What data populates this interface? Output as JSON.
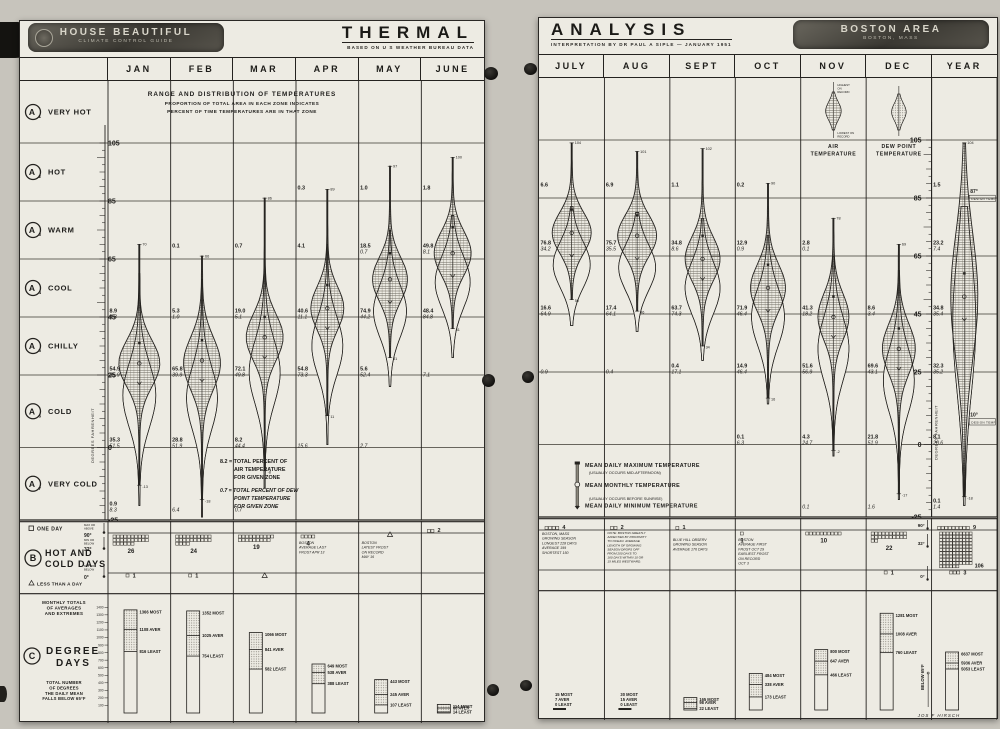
{
  "document": {
    "left_page": {
      "badge": {
        "line1": "HOUSE BEAUTIFUL",
        "line2": "CLIMATE CONTROL GUIDE"
      },
      "title": "THERMAL",
      "subtitle": "BASED ON U S WEATHER BUREAU DATA",
      "months": [
        "JAN",
        "FEB",
        "MAR",
        "APR",
        "MAY",
        "JUNE"
      ]
    },
    "right_page": {
      "title": "ANALYSIS",
      "subtitle": "INTERPRETATION BY DR PAUL A SIPLE  —  JANUARY 1951",
      "badge": {
        "line1": "BOSTON AREA",
        "line2": "BOSTON, MASS"
      },
      "months": [
        "JULY",
        "AUG",
        "SEPT",
        "OCT",
        "NOV",
        "DEC",
        "YEAR"
      ]
    },
    "intro": [
      "RANGE AND DISTRIBUTION OF TEMPERATURES",
      "PROPORTION OF TOTAL AREA IN EACH ZONE INDICATES",
      "PERCENT OF TIME TEMPERATURES ARE IN THAT ZONE"
    ],
    "zones": [
      {
        "letter": "A",
        "sub": "1",
        "label": "VERY HOT"
      },
      {
        "letter": "A",
        "sub": "2",
        "label": "HOT"
      },
      {
        "letter": "A",
        "sub": "3",
        "label": "WARM"
      },
      {
        "letter": "A",
        "sub": "4",
        "label": "COOL"
      },
      {
        "letter": "A",
        "sub": "5",
        "label": "CHILLY"
      },
      {
        "letter": "A",
        "sub": "6",
        "label": "COLD"
      },
      {
        "letter": "A",
        "sub": "7",
        "label": "VERY COLD"
      }
    ],
    "scale_label": "DEGREES FAHRENHEIT",
    "air_legend": [
      "8.2 = TOTAL PERCENT OF",
      "AIR TEMPERATURE",
      "FOR GIVEN ZONE"
    ],
    "dew_legend": [
      "0.7 = TOTAL PERCENT OF DEW",
      "POINT TEMPERATURE",
      "FOR GIVEN ZONE"
    ],
    "mean_legend": [
      "MEAN DAILY MAXIMUM TEMPERATURE",
      "(USUALLY OCCURS MID-AFTERNOON)",
      "MEAN MONTHLY TEMPERATURE",
      "(USUALLY OCCURS BEFORE SUNRISE)",
      "MEAN DAILY MINIMUM TEMPERATURE"
    ],
    "inset": {
      "highest": [
        "HIGHEST",
        "ON",
        "RECORD"
      ],
      "lowest": [
        "LOWEST ON",
        "RECORD"
      ],
      "air": [
        "AIR",
        "TEMPERATURE"
      ],
      "dew": [
        "DEW POINT",
        "TEMPERATURE"
      ]
    },
    "design_temps": [
      {
        "temp": "87°",
        "label": "DESIGN TEMP",
        "at": 87
      },
      {
        "temp": "10°",
        "label": "DESIGN TEMP",
        "at": 10
      }
    ],
    "signature": "JOS F HIRSCH"
  },
  "chart_data": {
    "type": "violin-distribution",
    "title": "THERMAL ANALYSIS — RANGE AND DISTRIBUTION OF TEMPERATURES, BOSTON AREA",
    "ylabel": "DEGREES FAHRENHEIT",
    "y_ticks": [
      105,
      85,
      65,
      45,
      25,
      0,
      -25
    ],
    "ylim": [
      -25,
      115
    ],
    "zone_bounds": {
      "very_hot": "105+",
      "hot": "85-105",
      "warm": "65-85",
      "cool": "45-65",
      "chilly": "25-45",
      "cold": "0-25",
      "very_cold": "-25-0"
    },
    "pct_format": "[air %, dew point %] of time in zone",
    "months": [
      {
        "name": "JAN",
        "page": "L",
        "col": 0,
        "record_high": 70,
        "record_low": -13,
        "markers": {
          "max": 36,
          "mean": 29,
          "min": 22
        },
        "pct": {
          "cool": [
            "8.9",
            "4.3"
          ],
          "chilly": [
            "54.9",
            "35.9"
          ],
          "cold": [
            "35.3",
            "51.5"
          ],
          "very_cold": [
            "0.9",
            "8.3"
          ]
        },
        "shape": {
          "air": {
            "c": 29,
            "s": 8,
            "w": 20
          },
          "dew": {
            "hi": 60,
            "lo": -20,
            "c": 18,
            "s": 11,
            "w": 16
          }
        }
      },
      {
        "name": "FEB",
        "page": "L",
        "col": 1,
        "record_high": 66,
        "record_low": -18,
        "markers": {
          "max": 37,
          "mean": 30,
          "min": 23
        },
        "pct": {
          "warm": [
            "0.1",
            null
          ],
          "cool": [
            "5.3",
            "1.0"
          ],
          "chilly": [
            "65.8",
            "39.9"
          ],
          "cold": [
            "28.8",
            "51.9"
          ],
          "very_cold": [
            null,
            "6.4"
          ]
        },
        "shape": {
          "air": {
            "c": 29,
            "s": 9,
            "w": 18
          },
          "dew": {
            "hi": 58,
            "lo": -24,
            "c": 17,
            "s": 11,
            "w": 15
          }
        }
      },
      {
        "name": "MAR",
        "page": "L",
        "col": 2,
        "record_high": 86,
        "record_low": -8,
        "markers": {
          "max": 45,
          "mean": 38,
          "min": 31
        },
        "pct": {
          "warm": [
            "0.7",
            null
          ],
          "cool": [
            "19.0",
            "5.1"
          ],
          "chilly": [
            "72.1",
            "49.8"
          ],
          "cold": [
            "8.2",
            "44.4"
          ],
          "very_cold": [
            null,
            "0.7"
          ]
        },
        "shape": {
          "air": {
            "c": 38,
            "s": 8,
            "w": 18
          },
          "dew": {
            "hi": 65,
            "lo": -14,
            "c": 26,
            "s": 11,
            "w": 15
          }
        }
      },
      {
        "name": "APR",
        "page": "L",
        "col": 3,
        "record_high": 89,
        "record_low": 11,
        "markers": {
          "max": 56,
          "mean": 48,
          "min": 41
        },
        "pct": {
          "hot": [
            "0.3",
            null
          ],
          "warm": [
            "4.1",
            null
          ],
          "cool": [
            "40.6",
            "11.1"
          ],
          "chilly": [
            "54.8",
            "73.3"
          ],
          "cold": [
            null,
            "15.6"
          ]
        },
        "shape": {
          "air": {
            "c": 48,
            "s": 7.5,
            "w": 16
          },
          "dew": {
            "hi": 70,
            "lo": 1,
            "c": 35,
            "s": 10,
            "w": 15
          }
        }
      },
      {
        "name": "MAY",
        "page": "L",
        "col": 4,
        "record_high": 97,
        "record_low": 31,
        "markers": {
          "max": 67,
          "mean": 58,
          "min": 50
        },
        "pct": {
          "hot": [
            "1.0",
            null
          ],
          "warm": [
            "18.5",
            "0.7"
          ],
          "cool": [
            "74.9",
            "44.2"
          ],
          "chilly": [
            "5.6",
            "52.4"
          ],
          "cold": [
            null,
            "2.7"
          ]
        },
        "shape": {
          "air": {
            "c": 58,
            "s": 7.5,
            "w": 17
          },
          "dew": {
            "hi": 75,
            "lo": 21,
            "c": 47,
            "s": 9,
            "w": 16
          }
        }
      },
      {
        "name": "JUNE",
        "page": "L",
        "col": 5,
        "record_high": 100,
        "record_low": 41,
        "markers": {
          "max": 76,
          "mean": 67,
          "min": 59
        },
        "pct": {
          "hot": [
            "1.8",
            null
          ],
          "warm": [
            "49.8",
            "8.1"
          ],
          "cool": [
            "48.4",
            "84.8"
          ],
          "chilly": [
            null,
            "7.1"
          ]
        },
        "shape": {
          "air": {
            "c": 67,
            "s": 7.5,
            "w": 18
          },
          "dew": {
            "hi": 80,
            "lo": 31,
            "c": 57,
            "s": 9,
            "w": 17
          }
        }
      },
      {
        "name": "JULY",
        "page": "R",
        "col": 0,
        "record_high": 104,
        "record_low": 50,
        "markers": {
          "max": 81,
          "mean": 73,
          "min": 65
        },
        "pct": {
          "hot": [
            "6.6",
            null
          ],
          "warm": [
            "76.8",
            "34.2"
          ],
          "cool": [
            "16.6",
            "64.9"
          ],
          "chilly": [
            null,
            "0.9"
          ]
        },
        "shape": {
          "air": {
            "c": 73,
            "s": 7,
            "w": 19
          },
          "dew": {
            "hi": 82,
            "lo": 41,
            "c": 62,
            "s": 8,
            "w": 18
          }
        }
      },
      {
        "name": "AUG",
        "page": "R",
        "col": 1,
        "record_high": 101,
        "record_low": 46,
        "markers": {
          "max": 79,
          "mean": 72,
          "min": 64
        },
        "pct": {
          "hot": [
            "6.9",
            null
          ],
          "warm": [
            "75.7",
            "35.5"
          ],
          "cool": [
            "17.4",
            "64.1"
          ],
          "chilly": [
            null,
            "0.4"
          ]
        },
        "shape": {
          "air": {
            "c": 72,
            "s": 7,
            "w": 19
          },
          "dew": {
            "hi": 80,
            "lo": 39,
            "c": 61,
            "s": 8,
            "w": 18
          }
        }
      },
      {
        "name": "SEPT",
        "page": "R",
        "col": 2,
        "record_high": 102,
        "record_low": 34,
        "markers": {
          "max": 72,
          "mean": 64,
          "min": 57
        },
        "pct": {
          "hot": [
            "1.1",
            null
          ],
          "warm": [
            "34.8",
            "8.6"
          ],
          "cool": [
            "63.7",
            "74.3"
          ],
          "chilly": [
            "0.4",
            "17.1"
          ]
        },
        "shape": {
          "air": {
            "c": 64,
            "s": 7.5,
            "w": 17
          },
          "dew": {
            "hi": 78,
            "lo": 29,
            "c": 54,
            "s": 9,
            "w": 17
          }
        }
      },
      {
        "name": "OCT",
        "page": "R",
        "col": 3,
        "record_high": 90,
        "record_low": 16,
        "markers": {
          "max": 62,
          "mean": 54,
          "min": 46
        },
        "pct": {
          "hot": [
            "0.2",
            null
          ],
          "warm": [
            "12.9",
            "0.9"
          ],
          "cool": [
            "71.9",
            "46.4"
          ],
          "chilly": [
            "14.9",
            "46.4"
          ],
          "cold": [
            "0.1",
            "6.3"
          ]
        },
        "shape": {
          "air": {
            "c": 54,
            "s": 8,
            "w": 17
          },
          "dew": {
            "hi": 72,
            "lo": 14,
            "c": 44,
            "s": 10,
            "w": 16
          }
        }
      },
      {
        "name": "NOV",
        "page": "R",
        "col": 4,
        "record_high": 78,
        "record_low": -2,
        "markers": {
          "max": 51,
          "mean": 44,
          "min": 37
        },
        "pct": {
          "warm": [
            "2.8",
            "0.1"
          ],
          "cool": [
            "41.3",
            "18.2"
          ],
          "chilly": [
            "51.6",
            "56.9"
          ],
          "cold": [
            "4.3",
            "24.7"
          ],
          "very_cold": [
            null,
            "0.1"
          ]
        },
        "shape": {
          "air": {
            "c": 44,
            "s": 8,
            "w": 15
          },
          "dew": {
            "hi": 65,
            "lo": -4,
            "c": 33,
            "s": 11,
            "w": 15
          }
        }
      },
      {
        "name": "DEC",
        "page": "R",
        "col": 5,
        "record_high": 69,
        "record_low": -17,
        "markers": {
          "max": 40,
          "mean": 33,
          "min": 26
        },
        "pct": {
          "cool": [
            "8.6",
            "3.4"
          ],
          "chilly": [
            "69.6",
            "43.1"
          ],
          "cold": [
            "21.8",
            "51.9"
          ],
          "very_cold": [
            null,
            "1.6"
          ]
        },
        "shape": {
          "air": {
            "c": 33,
            "s": 8.5,
            "w": 16
          },
          "dew": {
            "hi": 60,
            "lo": -19,
            "c": 22,
            "s": 11,
            "w": 15
          }
        }
      },
      {
        "name": "YEAR",
        "page": "R",
        "col": 6,
        "record_high": 104,
        "record_low": -18,
        "markers": {
          "max": 59,
          "mean": 51,
          "min": 43
        },
        "pct": {
          "hot": [
            "1.5",
            null
          ],
          "warm": [
            "23.2",
            "7.4"
          ],
          "cool": [
            "34.8",
            "35.4"
          ],
          "chilly": [
            "32.3",
            "35.2"
          ],
          "cold": [
            "8.1",
            "20.6"
          ],
          "very_cold": [
            "0.1",
            "1.4"
          ]
        },
        "shape": {
          "air": {
            "c": 51,
            "s": 22,
            "w": 13
          },
          "dew": {
            "hi": 82,
            "lo": -21,
            "c": 42,
            "s": 24,
            "w": 11
          }
        }
      }
    ]
  },
  "hot_cold_days": {
    "section_letter": "B",
    "title": [
      "HOT AND",
      "COLD DAYS"
    ],
    "legend": [
      {
        "symbol": "square",
        "label": "ONE DAY"
      },
      {
        "symbol": "triangle",
        "label": "LESS THAN A DAY"
      }
    ],
    "rows": [
      {
        "label": "MAX OR ABOVE",
        "temp": "90°"
      },
      {
        "label": "MIN OR BELOW",
        "temp": "32°"
      },
      {
        "label": "MIN OR BELOW",
        "temp": "0°"
      }
    ],
    "months": [
      {
        "name": "JAN",
        "page": "L",
        "col": 0,
        "below32": 26,
        "below0": 1
      },
      {
        "name": "FEB",
        "page": "L",
        "col": 1,
        "below32": 24,
        "below0": 1
      },
      {
        "name": "MAR",
        "page": "L",
        "col": 2,
        "below32": 19,
        "below0": "less"
      },
      {
        "name": "APR",
        "page": "L",
        "col": 3,
        "below32": 4,
        "note": [
          "BOSTON",
          "AVERAGE LAST",
          "FROST APR 13"
        ]
      },
      {
        "name": "MAY",
        "page": "L",
        "col": 4,
        "below32": "less",
        "note": [
          "BOSTON",
          "LATEST FROST",
          "ON RECORD",
          "MAY 16"
        ]
      },
      {
        "name": "JUNE",
        "page": "L",
        "col": 5,
        "above90": 2
      },
      {
        "name": "JULY",
        "page": "R",
        "col": 0,
        "above90": 4,
        "note": [
          "BOSTON, MASS",
          "GROWING SEASON",
          "LONGEST 228 DAYS",
          "AVERAGE 199",
          "SHORTEST 150"
        ]
      },
      {
        "name": "AUG",
        "page": "R",
        "col": 1,
        "above90": 2,
        "note": [
          "NOTE: BOSTON GREATLY",
          "AFFECTED BY PROXIMITY",
          "TO OCEAN. AVERAGE",
          "LENGTH OF GROWING",
          "SEASON DROPS OFF",
          "FROM 200 DAYS TO",
          "160 DAYS WITHIN 10 OR",
          "15 MILES WESTWARD."
        ]
      },
      {
        "name": "SEPT",
        "page": "R",
        "col": 2,
        "above90": 1,
        "note": [
          "BLUE HILL OBSERV",
          "GROWING SEASON",
          "AVERAGE 176 DAYS"
        ]
      },
      {
        "name": "OCT",
        "page": "R",
        "col": 3,
        "below32": 1,
        "note": [
          "BOSTON",
          "AVERAGE FIRST",
          "FROST OCT 29",
          "EARLIEST FROST",
          "ON RECORD",
          "OCT 3"
        ]
      },
      {
        "name": "NOV",
        "page": "R",
        "col": 4,
        "below32": 10
      },
      {
        "name": "DEC",
        "page": "R",
        "col": 5,
        "below32": 22,
        "below0": 1,
        "axis": true
      },
      {
        "name": "YEAR",
        "page": "R",
        "col": 6,
        "above90": 9,
        "below32": 106,
        "below0": 3
      }
    ]
  },
  "degree_days": {
    "section_letter": "C",
    "header": [
      "MONTHLY TOTALS",
      "OF AVERAGES",
      "AND EXTREMES"
    ],
    "title": [
      "DEGREE",
      "DAYS"
    ],
    "description": [
      "TOTAL NUMBER",
      "OF DEGREES",
      "THE DAILY MEAN",
      "FALLS BELOW 65°F"
    ],
    "labels": {
      "most": "MOST",
      "aver": "AVER",
      "least": "LEAST"
    },
    "axis_ticks": [
      100,
      200,
      300,
      400,
      500,
      600,
      700,
      800,
      900,
      1000,
      1100,
      1200,
      1300,
      1400
    ],
    "below_label": "BELOW 65°F",
    "signature": "JOS F HIRSCH",
    "months": [
      {
        "name": "JAN",
        "page": "L",
        "col": 0,
        "most": 1366,
        "aver": 1108,
        "least": 816
      },
      {
        "name": "FEB",
        "page": "L",
        "col": 1,
        "most": 1352,
        "aver": 1025,
        "least": 754
      },
      {
        "name": "MAR",
        "page": "L",
        "col": 2,
        "most": 1066,
        "aver": 841,
        "least": 582
      },
      {
        "name": "APR",
        "page": "L",
        "col": 3,
        "most": 649,
        "aver": 538,
        "least": 388
      },
      {
        "name": "MAY",
        "page": "L",
        "col": 4,
        "most": 443,
        "aver": 245,
        "least": 107
      },
      {
        "name": "JUNE",
        "page": "L",
        "col": 5,
        "most": 114,
        "aver": 66,
        "least": 14
      },
      {
        "name": "JULY",
        "page": "R",
        "col": 0,
        "most": 15,
        "aver": 7,
        "least": 0,
        "stub": true
      },
      {
        "name": "AUG",
        "page": "R",
        "col": 1,
        "most": 30,
        "aver": 15,
        "least": 0,
        "stub": true
      },
      {
        "name": "SEPT",
        "page": "R",
        "col": 2,
        "most": 165,
        "aver": 98,
        "least": 22
      },
      {
        "name": "OCT",
        "page": "R",
        "col": 3,
        "most": 484,
        "aver": 338,
        "least": 173
      },
      {
        "name": "NOV",
        "page": "R",
        "col": 4,
        "most": 800,
        "aver": 647,
        "least": 466
      },
      {
        "name": "DEC",
        "page": "R",
        "col": 5,
        "most": 1281,
        "aver": 1008,
        "least": 760,
        "below_label": true
      },
      {
        "name": "YEAR",
        "page": "R",
        "col": 6,
        "most": 6637,
        "aver": 5936,
        "least": 5053,
        "display_heights": {
          "most": 58,
          "aver": 47,
          "least": 41
        }
      }
    ]
  }
}
